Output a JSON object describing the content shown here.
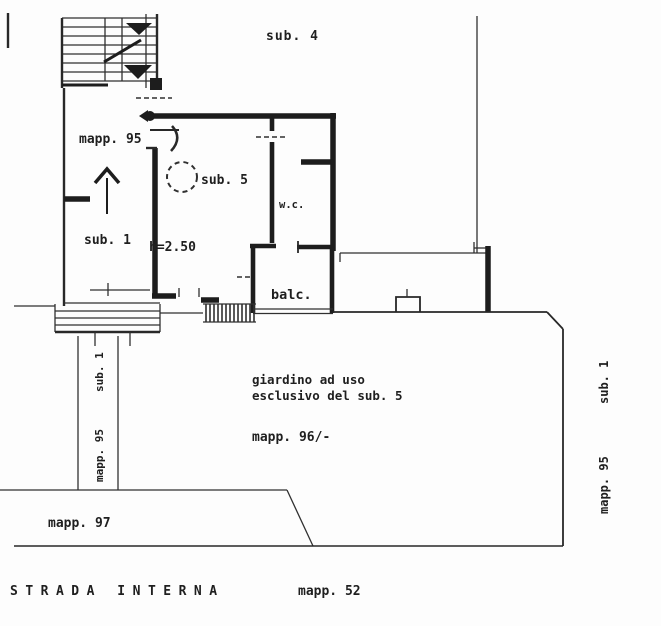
{
  "colors": {
    "ink": "#1d1d1d",
    "paper": "#fdfdfd"
  },
  "plan": {
    "upper_floor": {
      "sub4": "sub. 4"
    },
    "entrance": {
      "mapp_door": "mapp. 95"
    },
    "unit": {
      "sub5": "sub. 5",
      "sub1": "sub. 1",
      "height": "h=2.50",
      "wc": "w.c.",
      "balcony": "balc."
    },
    "garden": {
      "line1": "giardino ad uso",
      "line2": "esclusivo del sub. 5",
      "mapp": "mapp. 96/-"
    },
    "margins": {
      "left_mapp": "mapp. 95",
      "left_sub": "sub. 1",
      "right_mapp": "mapp. 95",
      "right_sub": "sub. 1"
    },
    "bottom": {
      "mapp97": "mapp. 97",
      "road": "STRADA INTERNA",
      "road_mapp": "mapp. 52"
    }
  }
}
